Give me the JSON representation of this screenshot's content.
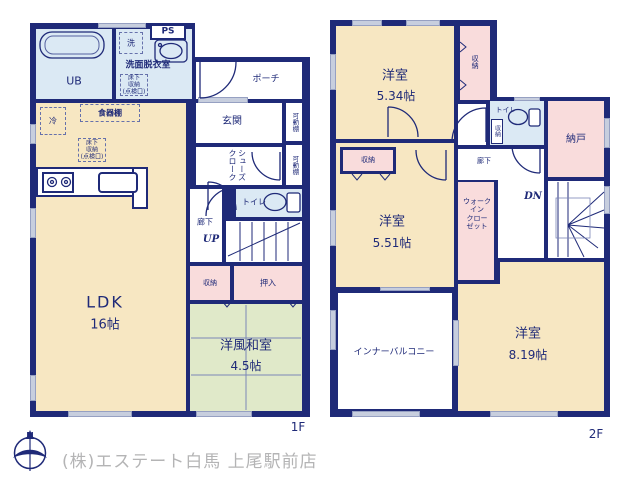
{
  "colors": {
    "wall": "#1f2a78",
    "room_cream": "#f7e7c2",
    "room_pink": "#f9dcdc",
    "room_green": "#e0e9c9",
    "room_blue": "#dbe9f4",
    "window_gray": "#c7cede",
    "text_navy": "#1f2a78",
    "footer_gray": "#b4b4b5"
  },
  "floor1": {
    "floor_label": "1F",
    "ub": "UB",
    "washer": "洗",
    "ps": "PS",
    "washroom": "洗面脱衣室",
    "underfloor_storage": "床下\n収納\n(点検口)",
    "fridge": "冷",
    "cupboard": "食器棚",
    "ldk_name": "LDK",
    "ldk_size": "16帖",
    "porch": "ポーチ",
    "entrance": "玄関",
    "movable_shelf": "可動棚",
    "shoes_closet": "シューズ\nクローク",
    "toilet": "トイレ",
    "hallway": "廊下",
    "stairs_up": "UP",
    "storage": "収納",
    "oshiire": "押入",
    "japanese_room_name": "洋風和室",
    "japanese_room_size": "4.5帖"
  },
  "floor2": {
    "floor_label": "2F",
    "room_534_name": "洋室",
    "room_534_size": "5.34帖",
    "closet_534": "収納",
    "toilet": "トイレ",
    "toilet_storage": "収納",
    "nando": "納戸",
    "hallway": "廊下",
    "stairs_down": "DN",
    "closet_551": "収納",
    "room_551_name": "洋室",
    "room_551_size": "5.51帖",
    "walk_in_closet": "ウォーク\nイン\nクロー\nゼット",
    "inner_balcony": "インナーバルコニー",
    "room_819_name": "洋室",
    "room_819_size": "8.19帖"
  },
  "footer": {
    "compass_north": "N",
    "company": "(株)エステート白馬 上尾駅前店"
  }
}
